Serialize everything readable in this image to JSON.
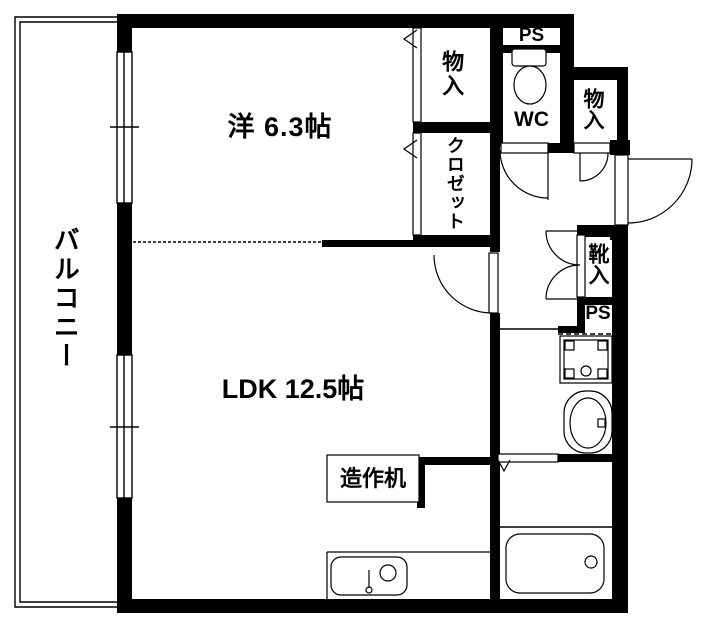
{
  "page": {
    "background": "#ffffff",
    "line_color": "#000000",
    "type": "apartment-floor-plan"
  },
  "labels": {
    "balcony": "バルコニー",
    "western_room": "洋 6.3帖",
    "ldk": "LDK 12.5帖",
    "storage_top": "物入",
    "closet": "クロゼット",
    "ps_top": "PS",
    "wc": "WC",
    "storage_entry": "物入",
    "shoe_cabinet": "靴入",
    "ps_mid": "PS",
    "built_in_desk": "造作机"
  }
}
